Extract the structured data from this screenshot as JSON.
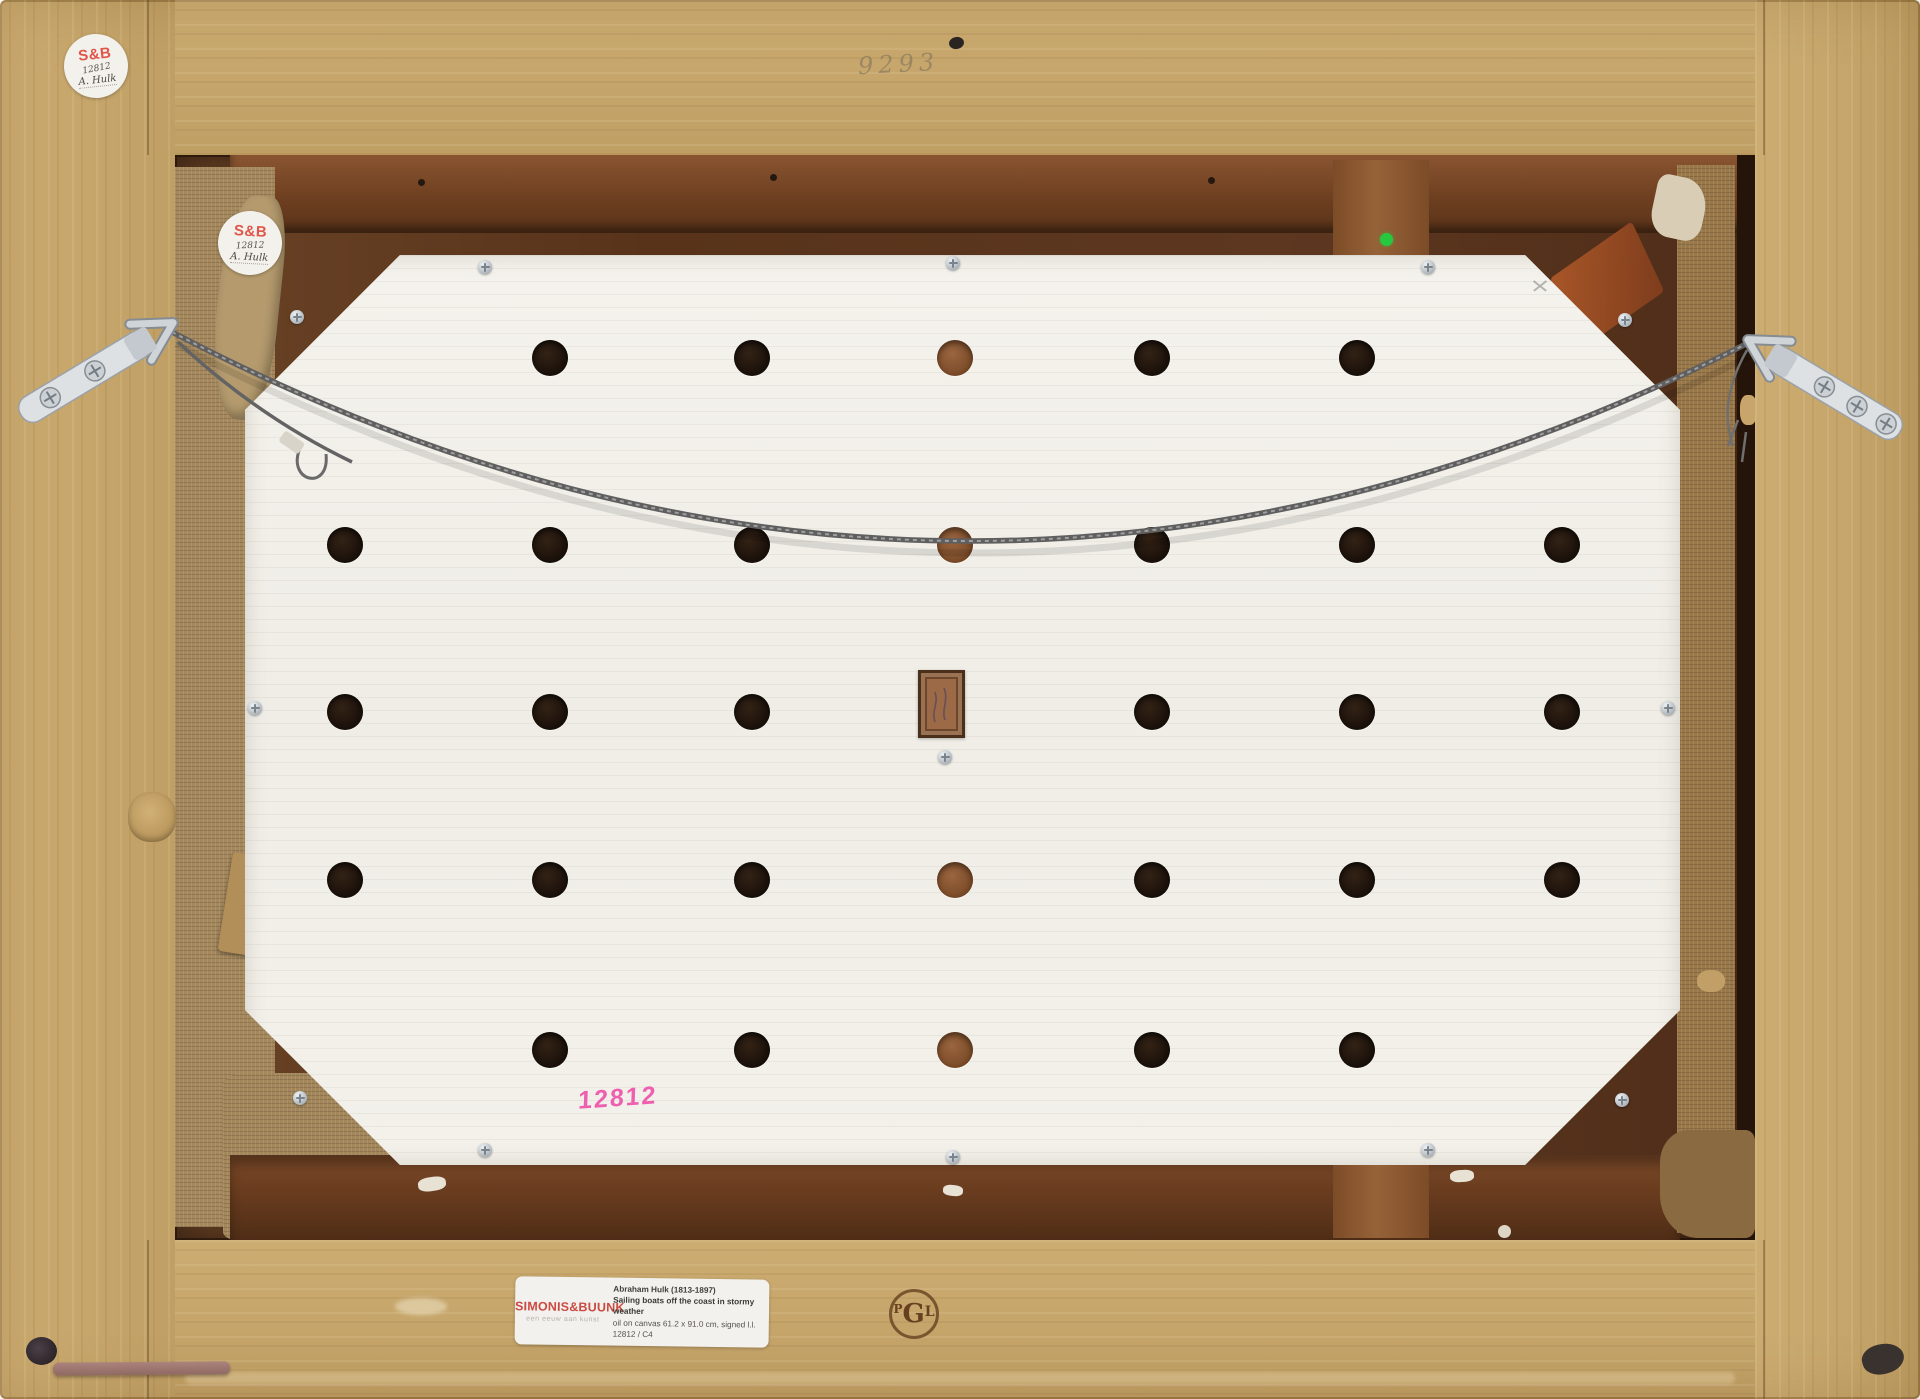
{
  "colors": {
    "frame_wood": "#c8a76b",
    "stretcher_wood": "#5d3720",
    "burlap": "#a5885c",
    "board_white": "#f2f0ea",
    "hole_dark": "#241810",
    "hole_brown": "#8a5a35",
    "wire_gray": "#6e6e6e",
    "hardware_zinc": "#dfe3e6",
    "dealer_red": "#cb4a42",
    "sticker_red": "#e0564a",
    "pink_marker": "#ef5fb0",
    "green_dot": "#27c840",
    "stamp_brown": "#5d3517"
  },
  "stickers": {
    "outer": {
      "brand": "S&B",
      "number": "12812",
      "artist": "A. Hulk"
    },
    "inner": {
      "brand": "S&B",
      "number": "12812",
      "artist": "A. Hulk"
    }
  },
  "inscriptions": {
    "pencil_number": "9293",
    "pink_number": "12812"
  },
  "dealer_label": {
    "name": "SIMONIS&BUUNK",
    "tagline": "een eeuw aan kunst",
    "artist": "Abraham Hulk (1813-1897)",
    "title": "Sailing boats off the coast in stormy weather",
    "details": "oil on canvas 61.2 x 91.0 cm, signed l.l.",
    "inventory": "12812 / C4"
  },
  "stamp": {
    "letters": [
      "P",
      "G",
      "L"
    ]
  },
  "backing_board": {
    "hole_rows": [
      {
        "y": 358,
        "holes": [
          {
            "x": 550,
            "tone": "dark"
          },
          {
            "x": 752,
            "tone": "dark"
          },
          {
            "x": 955,
            "tone": "brown"
          },
          {
            "x": 1152,
            "tone": "dark"
          },
          {
            "x": 1357,
            "tone": "dark"
          }
        ]
      },
      {
        "y": 545,
        "holes": [
          {
            "x": 345,
            "tone": "dark"
          },
          {
            "x": 550,
            "tone": "dark"
          },
          {
            "x": 752,
            "tone": "dark"
          },
          {
            "x": 955,
            "tone": "brown"
          },
          {
            "x": 1152,
            "tone": "dark"
          },
          {
            "x": 1357,
            "tone": "dark"
          },
          {
            "x": 1562,
            "tone": "dark"
          }
        ]
      },
      {
        "y": 712,
        "holes": [
          {
            "x": 345,
            "tone": "dark"
          },
          {
            "x": 550,
            "tone": "dark"
          },
          {
            "x": 752,
            "tone": "dark"
          },
          {
            "x": 1152,
            "tone": "dark"
          },
          {
            "x": 1357,
            "tone": "dark"
          },
          {
            "x": 1562,
            "tone": "dark"
          }
        ]
      },
      {
        "y": 880,
        "holes": [
          {
            "x": 345,
            "tone": "dark"
          },
          {
            "x": 550,
            "tone": "dark"
          },
          {
            "x": 752,
            "tone": "dark"
          },
          {
            "x": 955,
            "tone": "brown"
          },
          {
            "x": 1152,
            "tone": "dark"
          },
          {
            "x": 1357,
            "tone": "dark"
          },
          {
            "x": 1562,
            "tone": "dark"
          }
        ]
      },
      {
        "y": 1050,
        "holes": [
          {
            "x": 550,
            "tone": "dark"
          },
          {
            "x": 752,
            "tone": "dark"
          },
          {
            "x": 955,
            "tone": "brown"
          },
          {
            "x": 1152,
            "tone": "dark"
          },
          {
            "x": 1357,
            "tone": "dark"
          }
        ]
      }
    ],
    "screws": [
      [
        485,
        267
      ],
      [
        953,
        263
      ],
      [
        1428,
        267
      ],
      [
        297,
        317
      ],
      [
        1625,
        320
      ],
      [
        255,
        708
      ],
      [
        1668,
        708
      ],
      [
        300,
        1098
      ],
      [
        1622,
        1100
      ],
      [
        485,
        1150
      ],
      [
        953,
        1157
      ],
      [
        1428,
        1150
      ],
      [
        945,
        757
      ]
    ]
  }
}
